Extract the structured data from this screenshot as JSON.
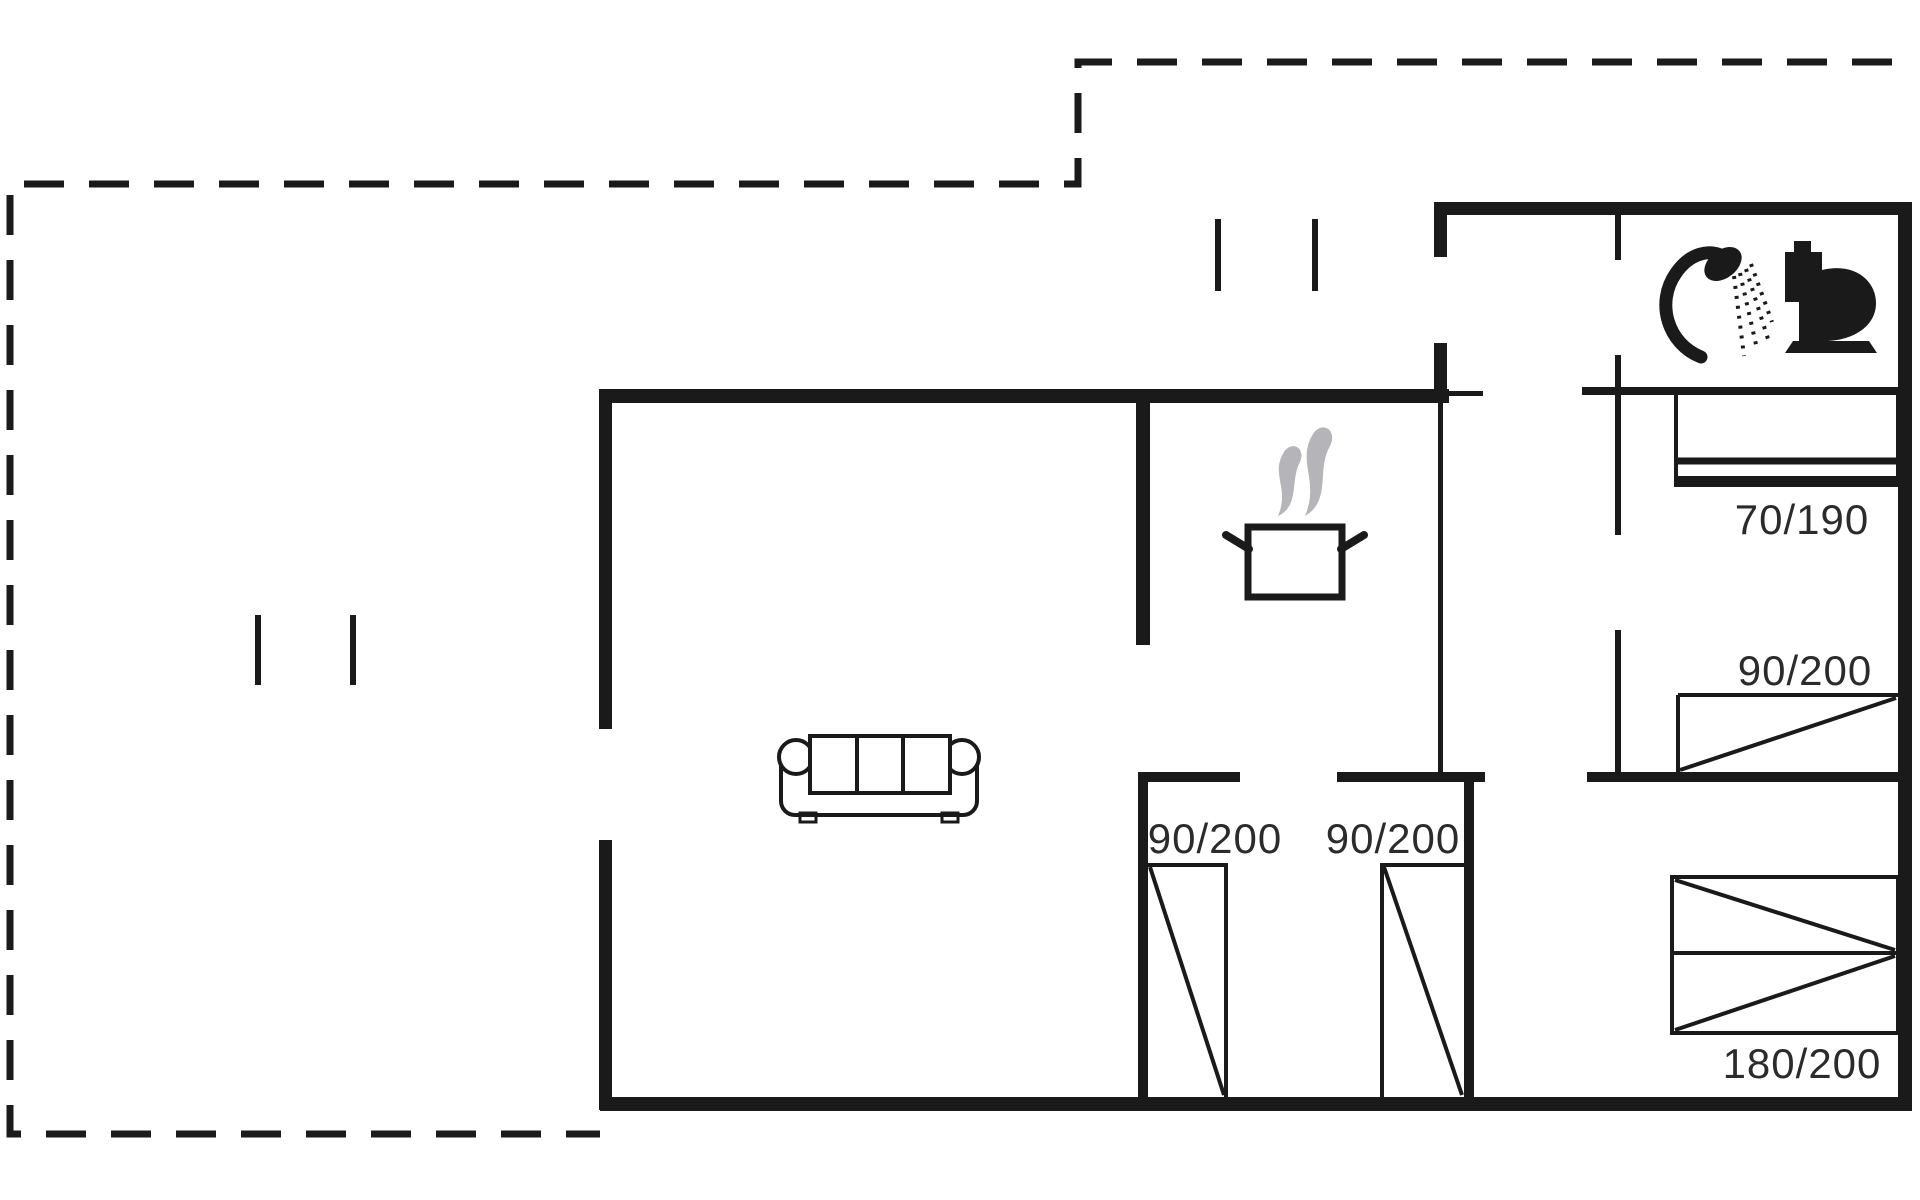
{
  "canvas": {
    "width": 1920,
    "height": 1200,
    "background": "#ffffff",
    "ink_color": "#1a1a1a",
    "steam_color": "#b4b4b9",
    "label_color": "#2b2b2b",
    "label_font_size": 42
  },
  "labels": [
    {
      "name": "label-bed-70-190",
      "text": "70/190",
      "x": 1802,
      "y": 534
    },
    {
      "name": "label-bed-90-200-right",
      "text": "90/200",
      "x": 1805,
      "y": 685
    },
    {
      "name": "label-closet-90-200-left",
      "text": "90/200",
      "x": 1215,
      "y": 853
    },
    {
      "name": "label-closet-90-200-right",
      "text": "90/200",
      "x": 1393,
      "y": 853
    },
    {
      "name": "label-bed-180-200",
      "text": "180/200",
      "x": 1802,
      "y": 1078
    }
  ],
  "dashed_outline": {
    "name": "terrace-dashed-outline",
    "path": "M1892 62 H1078 V184 H10 V1134 H600",
    "stroke_width": 7,
    "dash": "40 25"
  },
  "walls": [
    {
      "name": "wall-top-main",
      "x": 600,
      "y": 389,
      "w": 849,
      "h": 14
    },
    {
      "name": "wall-left-upper",
      "x": 599,
      "y": 389,
      "w": 13,
      "h": 340
    },
    {
      "name": "wall-left-lower",
      "x": 599,
      "y": 840,
      "w": 13,
      "h": 270
    },
    {
      "name": "wall-bottom",
      "x": 600,
      "y": 1097,
      "w": 1312,
      "h": 14
    },
    {
      "name": "wall-right",
      "x": 1898,
      "y": 202,
      "w": 14,
      "h": 909
    },
    {
      "name": "wall-top-right",
      "x": 1435,
      "y": 202,
      "w": 477,
      "h": 13
    },
    {
      "name": "wall-entry-stub",
      "x": 1434,
      "y": 202,
      "w": 13,
      "h": 55
    },
    {
      "name": "wall-entry-lower",
      "x": 1434,
      "y": 343,
      "w": 13,
      "h": 53
    },
    {
      "name": "wall-kitchen-divider",
      "x": 1136,
      "y": 389,
      "w": 14,
      "h": 256
    },
    {
      "name": "wall-closetroom-top-left",
      "x": 1138,
      "y": 772,
      "w": 102,
      "h": 10
    },
    {
      "name": "wall-closetroom-top-right",
      "x": 1337,
      "y": 772,
      "w": 148,
      "h": 10
    },
    {
      "name": "wall-bedroom-mid-bottom",
      "x": 1587,
      "y": 772,
      "w": 325,
      "h": 10
    },
    {
      "name": "wall-closetroom-left",
      "x": 1138,
      "y": 772,
      "w": 10,
      "h": 332
    },
    {
      "name": "wall-closetroom-right",
      "x": 1464,
      "y": 772,
      "w": 10,
      "h": 332
    },
    {
      "name": "wall-bathroom-bottom",
      "x": 1582,
      "y": 387,
      "w": 330,
      "h": 8
    },
    {
      "name": "wall-hall-right-lower",
      "x": 1438,
      "y": 396,
      "w": 5,
      "h": 381
    },
    {
      "name": "wall-bath-divider-a",
      "x": 1615,
      "y": 212,
      "w": 6,
      "h": 48
    },
    {
      "name": "wall-bath-divider-b",
      "x": 1615,
      "y": 355,
      "w": 6,
      "h": 180
    },
    {
      "name": "wall-bath-divider-c",
      "x": 1615,
      "y": 630,
      "w": 6,
      "h": 147
    },
    {
      "name": "door-jamb-tick",
      "x": 1443,
      "y": 391,
      "w": 40,
      "h": 5
    },
    {
      "name": "post-terrace-top-1",
      "x": 1215,
      "y": 219,
      "w": 6,
      "h": 72
    },
    {
      "name": "post-terrace-top-2",
      "x": 1312,
      "y": 219,
      "w": 6,
      "h": 72
    },
    {
      "name": "post-terrace-left-1",
      "x": 255,
      "y": 615,
      "w": 6,
      "h": 70
    },
    {
      "name": "post-terrace-left-2",
      "x": 350,
      "y": 615,
      "w": 6,
      "h": 70
    }
  ],
  "furniture": [
    {
      "name": "bed-70-190-outline",
      "type": "rect",
      "x": 1676,
      "y": 393,
      "w": 222,
      "h": 92,
      "fill": "none",
      "sw": 4
    },
    {
      "name": "bed-70-190-line-1",
      "type": "line",
      "x1": 1676,
      "y1": 461,
      "x2": 1898,
      "y2": 461,
      "sw": 7
    },
    {
      "name": "bed-70-190-line-2",
      "type": "line",
      "x1": 1676,
      "y1": 480,
      "x2": 1898,
      "y2": 480,
      "sw": 8
    },
    {
      "name": "bed-90-200-top",
      "type": "line",
      "x1": 1678,
      "y1": 695,
      "x2": 1898,
      "y2": 695,
      "sw": 4
    },
    {
      "name": "bed-90-200-left",
      "type": "line",
      "x1": 1678,
      "y1": 695,
      "x2": 1678,
      "y2": 772,
      "sw": 4
    },
    {
      "name": "bed-90-200-diagonal",
      "type": "line",
      "x1": 1680,
      "y1": 770,
      "x2": 1896,
      "y2": 698,
      "sw": 4
    },
    {
      "name": "bed-180-200-outline",
      "type": "rect",
      "x": 1672,
      "y": 877,
      "w": 226,
      "h": 156,
      "fill": "none",
      "sw": 4
    },
    {
      "name": "bed-180-200-mid",
      "type": "line",
      "x1": 1672,
      "y1": 953,
      "x2": 1898,
      "y2": 953,
      "sw": 4
    },
    {
      "name": "bed-180-200-diag-top",
      "type": "line",
      "x1": 1675,
      "y1": 880,
      "x2": 1895,
      "y2": 950,
      "sw": 4
    },
    {
      "name": "bed-180-200-diag-bot",
      "type": "line",
      "x1": 1675,
      "y1": 1030,
      "x2": 1895,
      "y2": 956,
      "sw": 4
    },
    {
      "name": "closet-left-top",
      "type": "line",
      "x1": 1148,
      "y1": 865,
      "x2": 1228,
      "y2": 865,
      "sw": 4
    },
    {
      "name": "closet-left-side",
      "type": "line",
      "x1": 1226,
      "y1": 865,
      "x2": 1226,
      "y2": 1097,
      "sw": 4
    },
    {
      "name": "closet-left-diagonal",
      "type": "line",
      "x1": 1150,
      "y1": 867,
      "x2": 1224,
      "y2": 1095,
      "sw": 4
    },
    {
      "name": "closet-right-top",
      "type": "line",
      "x1": 1380,
      "y1": 865,
      "x2": 1464,
      "y2": 865,
      "sw": 4
    },
    {
      "name": "closet-right-side",
      "type": "line",
      "x1": 1382,
      "y1": 865,
      "x2": 1382,
      "y2": 1097,
      "sw": 4
    },
    {
      "name": "closet-right-diagonal",
      "type": "line",
      "x1": 1384,
      "y1": 867,
      "x2": 1462,
      "y2": 1095,
      "sw": 4
    },
    {
      "name": "sofa-body",
      "type": "rect",
      "x": 781,
      "y": 745,
      "w": 196,
      "h": 70,
      "rx": 14,
      "fill": "#ffffff",
      "sw": 4
    },
    {
      "name": "sofa-foot-left",
      "type": "rect",
      "x": 800,
      "y": 813,
      "w": 16,
      "h": 9,
      "fill": "none",
      "sw": 3
    },
    {
      "name": "sofa-foot-right",
      "type": "rect",
      "x": 942,
      "y": 813,
      "w": 16,
      "h": 9,
      "fill": "none",
      "sw": 3
    },
    {
      "name": "sofa-arm-left",
      "type": "circle",
      "cx": 796,
      "cy": 757,
      "r": 17,
      "fill": "#ffffff",
      "sw": 4
    },
    {
      "name": "sofa-arm-right",
      "type": "circle",
      "cx": 962,
      "cy": 757,
      "r": 17,
      "fill": "#ffffff",
      "sw": 4
    },
    {
      "name": "sofa-back",
      "type": "rect",
      "x": 810,
      "y": 736,
      "w": 140,
      "h": 57,
      "fill": "#ffffff",
      "sw": 4
    },
    {
      "name": "sofa-cushion-div-1",
      "type": "line",
      "x1": 857,
      "y1": 736,
      "x2": 857,
      "y2": 793,
      "sw": 4
    },
    {
      "name": "sofa-cushion-div-2",
      "type": "line",
      "x1": 903,
      "y1": 736,
      "x2": 903,
      "y2": 793,
      "sw": 4
    }
  ],
  "icons": [
    {
      "name": "steam-icon-1",
      "type": "path",
      "d": "M1284 452 C1270 474 1290 488 1278 516 C1300 506 1290 480 1300 462 C1306 448 1292 440 1284 452 Z",
      "fill": "steam"
    },
    {
      "name": "steam-icon-2",
      "type": "path",
      "d": "M1313 434 C1296 462 1320 480 1305 516 C1332 500 1316 470 1330 446 C1338 430 1322 420 1313 434 Z",
      "fill": "steam"
    },
    {
      "name": "cooking-pot-icon",
      "type": "rect",
      "x": 1248,
      "y": 527,
      "w": 94,
      "h": 70,
      "fill": "#ffffff",
      "sw": 7
    },
    {
      "name": "pot-handle-left",
      "type": "line",
      "x1": 1249,
      "y1": 549,
      "x2": 1226,
      "y2": 535,
      "sw": 8,
      "cap": "round"
    },
    {
      "name": "pot-handle-right",
      "type": "line",
      "x1": 1341,
      "y1": 549,
      "x2": 1364,
      "y2": 535,
      "sw": 8,
      "cap": "round"
    },
    {
      "name": "shower-hose-icon",
      "type": "path",
      "d": "M1701 357 C1668 344 1655 303 1676 273 C1689 254 1710 247 1726 258",
      "fill": "none",
      "sw": 13,
      "cap": "round"
    },
    {
      "name": "shower-head-icon",
      "type": "ellipse",
      "cx": 1723,
      "cy": 264,
      "rx": 21,
      "ry": 14,
      "fill": "ink",
      "transform": "rotate(-38 1723 264)"
    },
    {
      "name": "shower-spray-1",
      "type": "line",
      "x1": 1734,
      "y1": 276,
      "x2": 1744,
      "y2": 356,
      "sw": 4,
      "dash": "3 7"
    },
    {
      "name": "shower-spray-2",
      "type": "line",
      "x1": 1740,
      "y1": 273,
      "x2": 1757,
      "y2": 349,
      "sw": 4,
      "dash": "3 7"
    },
    {
      "name": "shower-spray-3",
      "type": "line",
      "x1": 1746,
      "y1": 269,
      "x2": 1768,
      "y2": 339,
      "sw": 4,
      "dash": "3 7"
    },
    {
      "name": "shower-spray-4",
      "type": "line",
      "x1": 1751,
      "y1": 264,
      "x2": 1772,
      "y2": 322,
      "sw": 4,
      "dash": "3 7"
    },
    {
      "name": "toilet-tank-cap-icon",
      "type": "rect",
      "x": 1794,
      "y": 241,
      "w": 17,
      "h": 12,
      "fill": "ink"
    },
    {
      "name": "toilet-tank-icon",
      "type": "rect",
      "x": 1785,
      "y": 252,
      "w": 37,
      "h": 50,
      "fill": "ink"
    },
    {
      "name": "toilet-bowl-icon",
      "type": "path",
      "d": "M1822 270 C1855 262 1876 281 1876 303 C1876 326 1854 340 1827 341 L1799 341 L1799 302 L1822 302 Z",
      "fill": "ink"
    },
    {
      "name": "toilet-base-icon",
      "type": "path",
      "d": "M1793 341 L1869 341 L1877 353 L1785 353 Z",
      "fill": "ink"
    }
  ]
}
